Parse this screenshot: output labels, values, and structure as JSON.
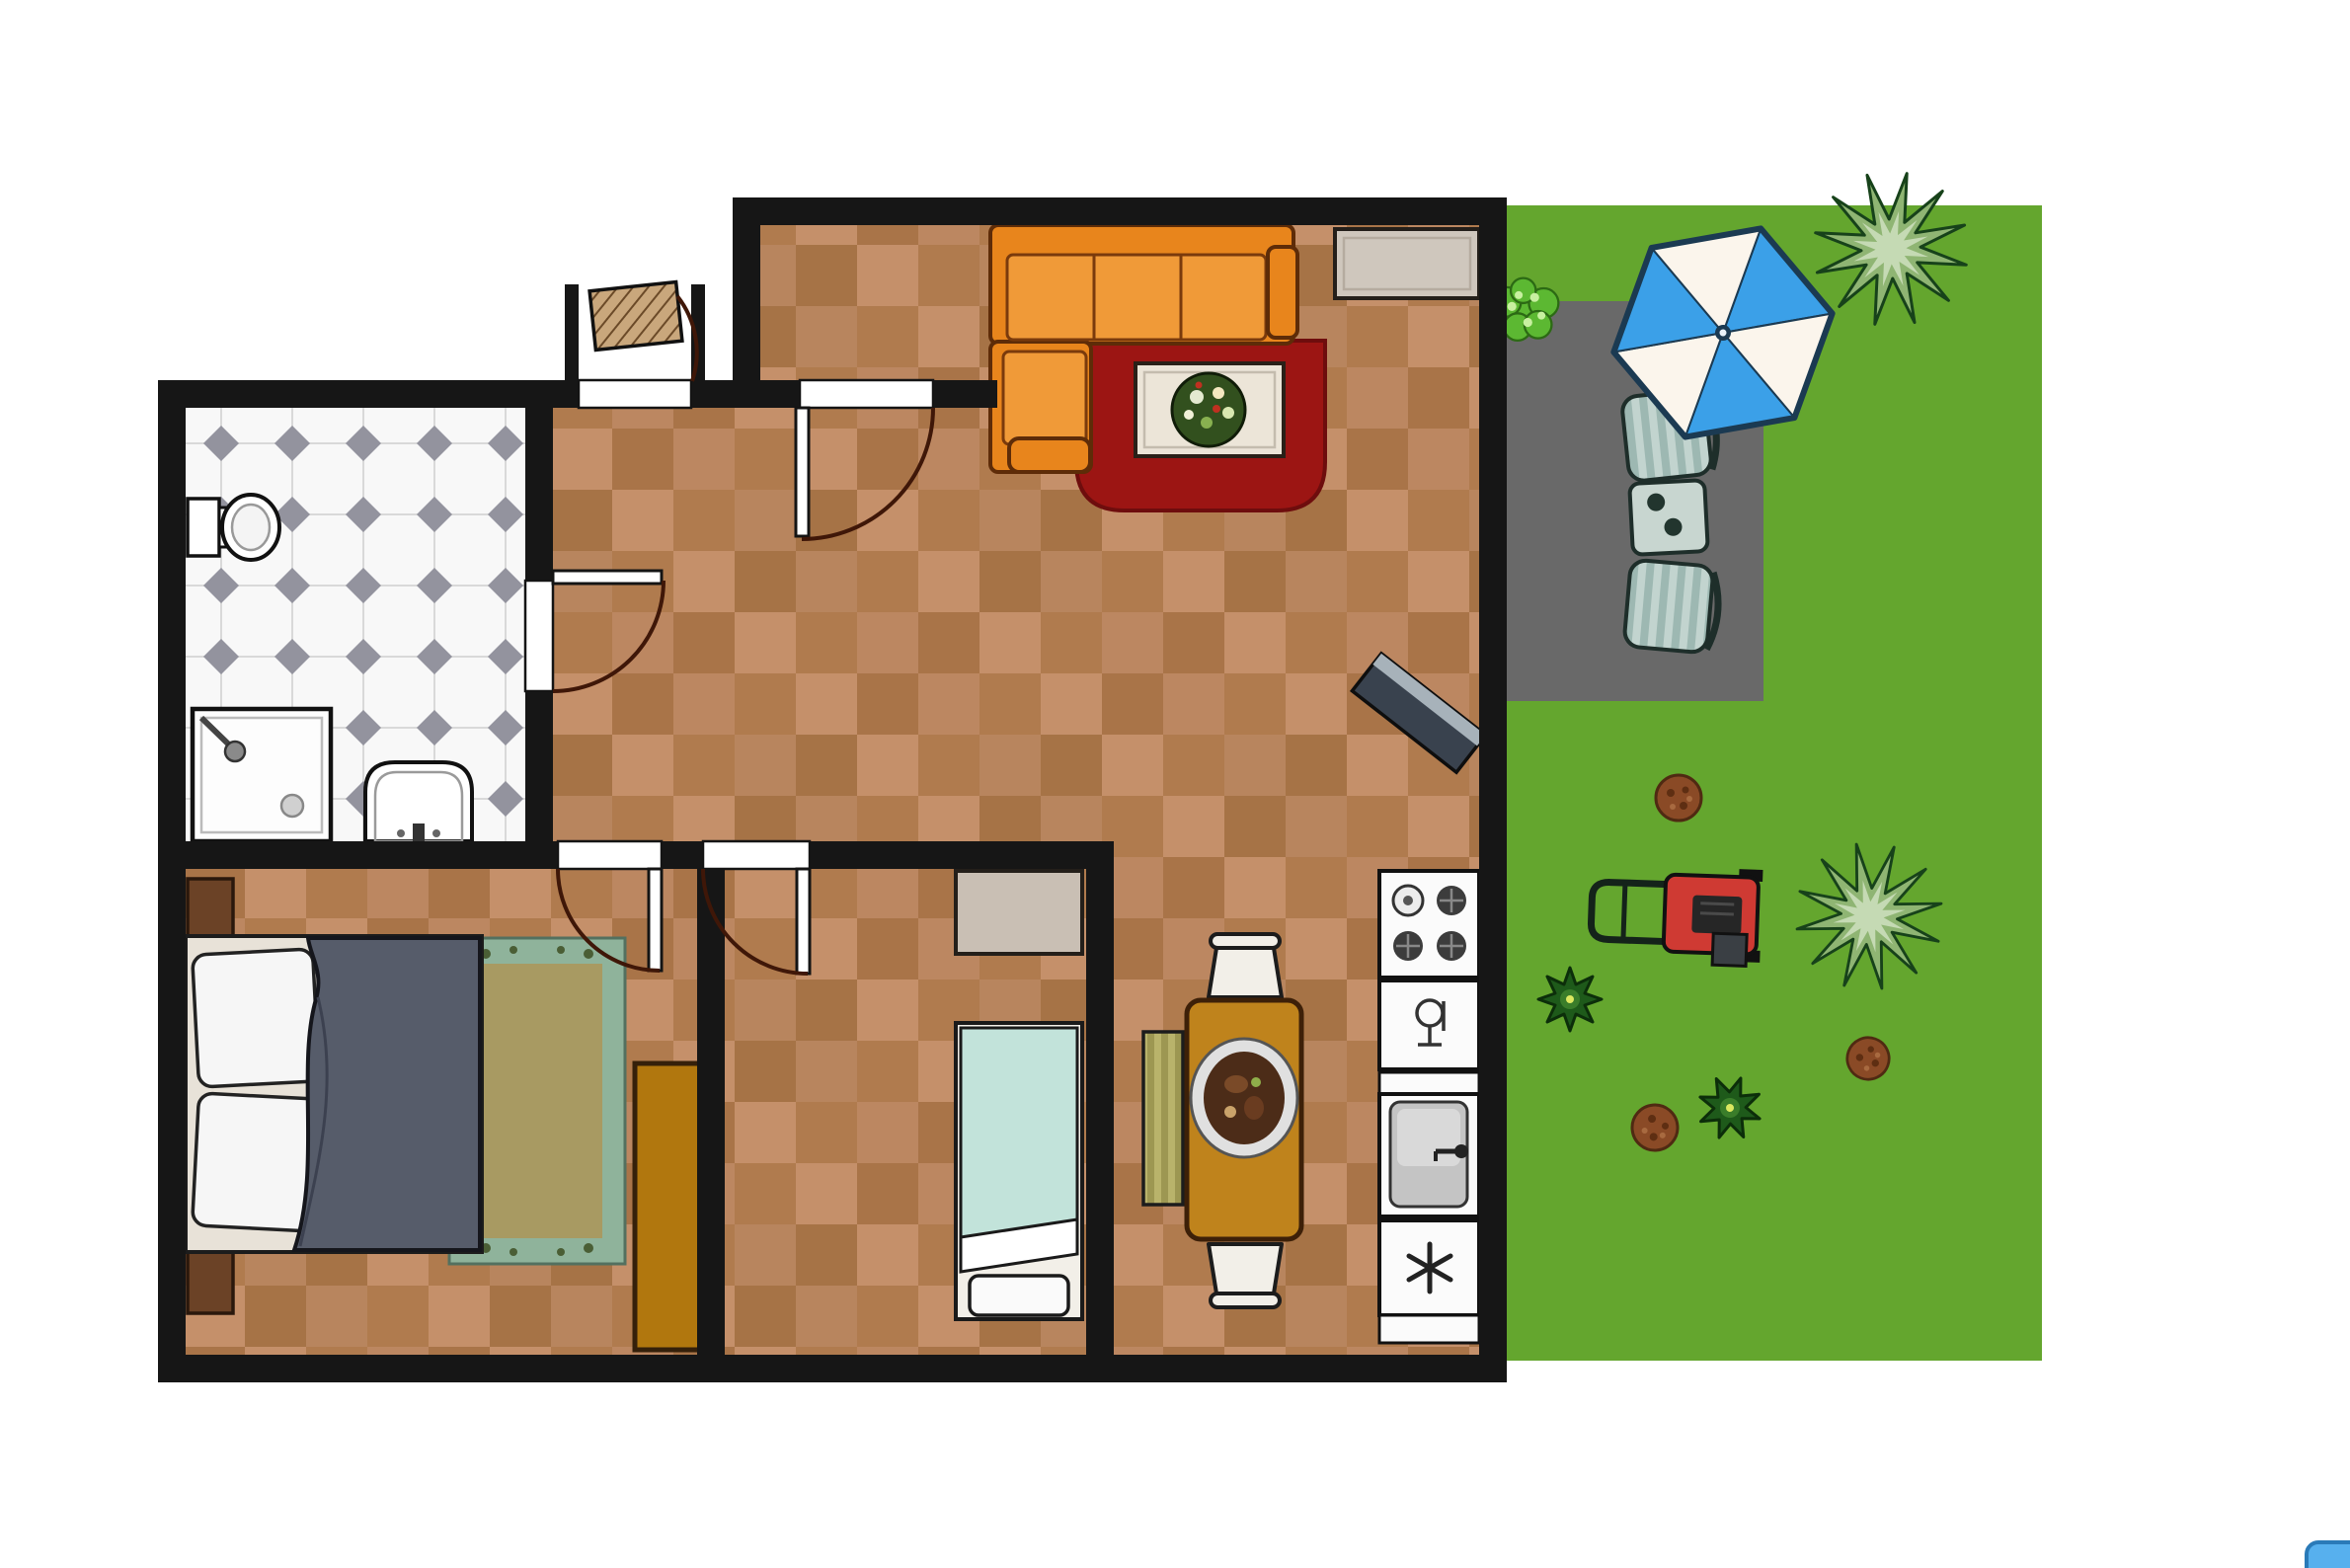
{
  "image_type": "architectural floor plan of an apartment with adjacent garden, top-down 2D view",
  "visible_text": [],
  "palette": {
    "wall": "#161616",
    "tile_light": "#c5906a",
    "tile_dark": "#b07b4e",
    "tile_shade": "#6e4018",
    "bath_floor": "#f8f8f8",
    "bath_grid": "#d9d9d9",
    "bath_diamond": "#93939e",
    "grass": "#64a62e",
    "patio": "#696969",
    "umbrella_blue": "#3ba0e8",
    "umbrella_white": "#fbf5ec",
    "sofa_orange": "#e8851c",
    "sofa_border": "#5e2c08",
    "rug_red": "#9c1513",
    "rug_sage": "#8fb39b",
    "rug_olive": "#a89a62",
    "blanket_slate": "#565c6a",
    "bed2_aqua": "#c2e3da",
    "wardrobe_gold": "#b1770e",
    "table_gold": "#bf831c",
    "mower_red": "#cf3a33",
    "door_arc": "#3f1708",
    "chair_stripe_a": "#9db8b2",
    "chair_stripe_b": "#c2d4cf",
    "bench_stripe_a": "#b9b36b",
    "bench_stripe_b": "#9d9752"
  },
  "rooms": [
    "living-room",
    "kitchen-dining",
    "hallway",
    "bathroom",
    "master-bedroom",
    "small-bedroom",
    "entry-vestibule",
    "garden"
  ],
  "objects": {
    "living_room": [
      "orange-corner-sofa",
      "red-rug",
      "coffee-table-with-plant",
      "sideboard",
      "corner-tv-unit"
    ],
    "kitchen_dining": [
      "stove",
      "dishwasher",
      "sink-counter",
      "freezer",
      "dining-table-with-platter",
      "chair-top",
      "chair-bottom",
      "striped-bench"
    ],
    "bathroom": [
      "toilet",
      "shower",
      "washbasin"
    ],
    "master_bedroom": [
      "double-bed",
      "pillows",
      "nightstand-top",
      "nightstand-bottom",
      "area-rug",
      "wardrobe"
    ],
    "small_bedroom": [
      "single-bed",
      "dresser"
    ],
    "garden": [
      "parasol",
      "lounge-chair-1",
      "garden-table-with-cups",
      "lounge-chair-2",
      "lawn-mower",
      "agave-plant-top",
      "agave-plant-middle",
      "light-bush",
      "dark-bush-1",
      "dark-bush-2",
      "dirt-patch-1",
      "dirt-patch-2",
      "dirt-patch-3",
      "patio-slab"
    ],
    "misc": [
      "entry-door",
      "interior-doors",
      "blue-corner-artifact"
    ]
  }
}
